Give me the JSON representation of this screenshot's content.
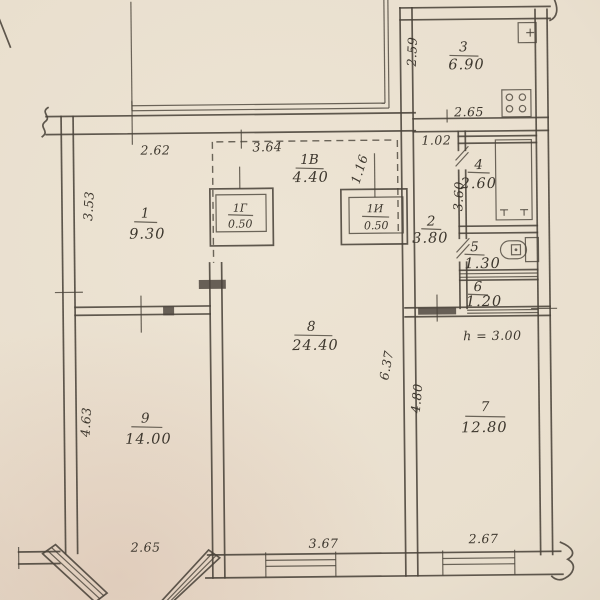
{
  "rooms": {
    "room1": {
      "num": "1",
      "area": "9.30"
    },
    "room2": {
      "num": "2",
      "area": "3.80"
    },
    "room3": {
      "num": "3",
      "area": "6.90"
    },
    "room4": {
      "num": "4",
      "area": "2.60"
    },
    "room5": {
      "num": "5",
      "area": "1.30"
    },
    "room6": {
      "num": "6",
      "area": "1.20"
    },
    "room7": {
      "num": "7",
      "area": "12.80"
    },
    "room8": {
      "num": "8",
      "area": "24.40"
    },
    "room9": {
      "num": "9",
      "area": "14.00"
    },
    "corridor": {
      "num": "1В",
      "area": "4.40"
    },
    "closet_left": {
      "num": "1Г",
      "area": "0.50"
    },
    "closet_right": {
      "num": "1И",
      "area": "0.50"
    }
  },
  "dimensions": {
    "top_wall_left": "2.62",
    "corridor_top": "3.64",
    "corridor_diag": "1.16",
    "kitchen_left": "2.59",
    "kitchen_bottom": "2.65",
    "hall_top": "1.02",
    "bath_left": "3.60",
    "room1_side": "3.53",
    "room9_side": "4.63",
    "room8_side": "6.37",
    "room7_side": "4.80",
    "bay_bottom": "2.65",
    "bottom_window_center": "3.67",
    "bottom_window_right": "2.67"
  },
  "notes": {
    "ceiling_height": "h = 3.00"
  },
  "icons": {
    "kitchen": [
      "stove-icon",
      "sink-icon"
    ],
    "bathroom": [
      "bathtub-icon"
    ],
    "wc": [
      "toilet-icon"
    ]
  },
  "colors": {
    "paper": "#e9dfce",
    "ink": "#49423a"
  }
}
